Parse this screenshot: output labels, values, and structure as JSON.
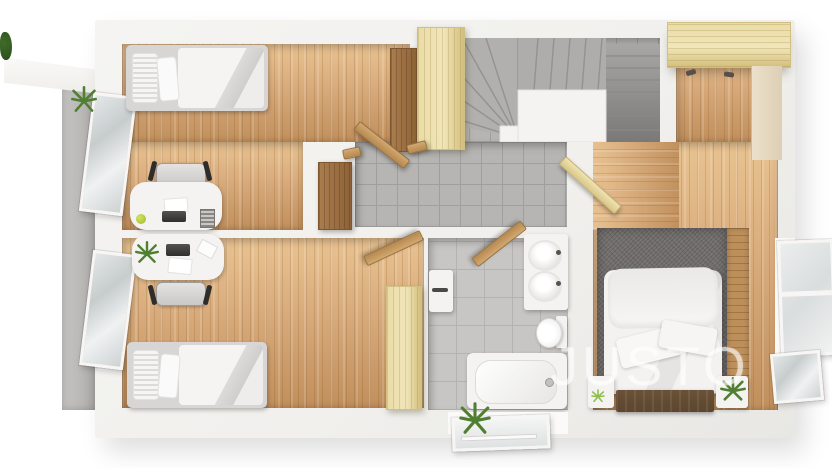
{
  "watermark": {
    "text": "JUSTO"
  },
  "palette": {
    "bg": "#ffffff",
    "wall": "#f1f0ed",
    "wall-bright": "#fbfaf9",
    "wood": "#d8ab7c",
    "wood-grain": "#c08f5c",
    "wood-light": "#e9c392",
    "pale-wood": "#eadca6",
    "pale-grain": "#d3bf7d",
    "oak-strip": "#bd8f5b",
    "brown": "#aa7d4e",
    "brown-dark": "#8d6238",
    "dark-wood": "#5c462f",
    "tile": "#b6b5b3",
    "tile-line": "#a19f9d",
    "bath-tile": "#c8c6c4",
    "bath-tile-line": "#b5b3b1",
    "rug": "#716e6c",
    "concrete": "#bab8b6",
    "white-furn": "#f4f3f1",
    "gray-bed": "#d7d6d4",
    "glass": "#d7dcdd",
    "green": "#4f7f30",
    "green-light": "#8fbf4d",
    "black": "#2e2d2b",
    "watermark": "rgba(255,255,255,0.55)"
  },
  "floorplan": {
    "view": "top-down-3d-render",
    "rooms": [
      {
        "name": "bedroom-upper-left",
        "floor": "wood",
        "furniture": [
          "single-bed",
          "desk",
          "office-chair",
          "laptop",
          "tall-brown-cabinet",
          "pale-wardrobe",
          "open-window"
        ]
      },
      {
        "name": "bedroom-lower-left",
        "floor": "wood",
        "furniture": [
          "single-bed",
          "desk",
          "office-chair",
          "laptop",
          "desk-plant",
          "pale-wardrobe",
          "open-window"
        ]
      },
      {
        "name": "hallway",
        "floor": "gray-tile",
        "furniture": [
          "brown-closet",
          "open-doors"
        ]
      },
      {
        "name": "staircase",
        "floor": "gray-tile",
        "furniture": [
          "winder-stairs",
          "stair-core-wall"
        ]
      },
      {
        "name": "bathroom",
        "floor": "gray-tile",
        "furniture": [
          "bathtub",
          "wall-hung-toilet",
          "double-sink-vanity",
          "towel-rail",
          "open-door"
        ]
      },
      {
        "name": "master-bedroom",
        "floor": "wood",
        "furniture": [
          "double-bed",
          "dark-wood-bed-base",
          "gray-rug",
          "oak-strip",
          "nightstand-left",
          "nightstand-right",
          "plants",
          "pale-wardrobe",
          "open-window"
        ]
      },
      {
        "name": "balcony",
        "floor": "concrete",
        "furniture": [
          "roof-overhang",
          "plant"
        ]
      },
      {
        "name": "exterior-bottom",
        "furniture": [
          "open-skylight-window",
          "plant"
        ]
      }
    ]
  }
}
